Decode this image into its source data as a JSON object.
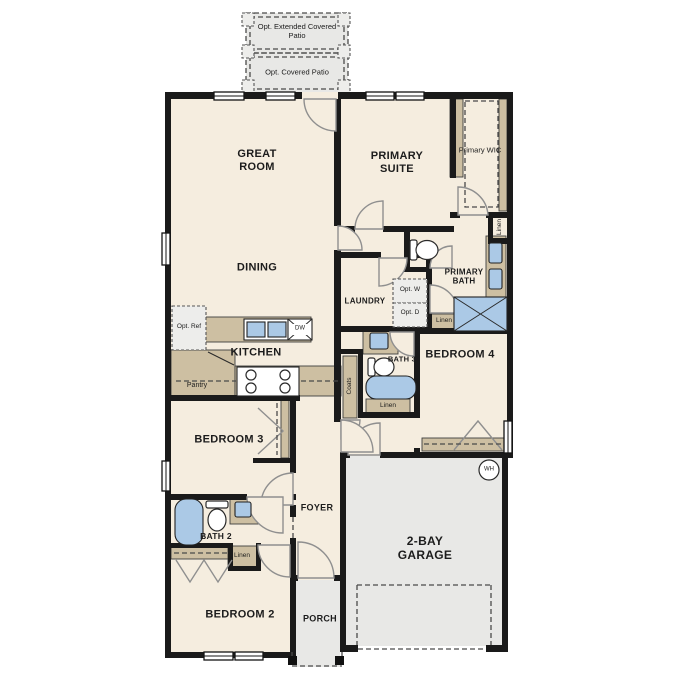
{
  "colors": {
    "floor": "#f5eddf",
    "wall": "#1a1a1a",
    "cabinet": "#cdbfa2",
    "concrete": "#e8e8e6",
    "fixture": "#abc9e6",
    "dash": "#4a4a4a"
  },
  "patio": {
    "extended_label": "Opt. Extended Covered Patio",
    "covered_label": "Opt. Covered Patio"
  },
  "rooms": {
    "great_room": "GREAT ROOM",
    "dining": "DINING",
    "kitchen": "KITCHEN",
    "primary_suite": "PRIMARY SUITE",
    "primary_wic": "Primary WIC",
    "primary_bath": "PRIMARY BATH",
    "laundry": "LAUNDRY",
    "bath_3": "BATH 3",
    "bedroom_4": "BEDROOM 4",
    "bedroom_3": "BEDROOM 3",
    "foyer": "FOYER",
    "bath_2": "BATH 2",
    "bedroom_2": "BEDROOM 2",
    "porch": "PORCH",
    "garage": "2-BAY GARAGE"
  },
  "closets": {
    "pantry": "Pantry",
    "coats": "Coats",
    "linen": "Linen"
  },
  "appliances": {
    "opt_ref": "Opt. Ref",
    "opt_washer": "Opt. W",
    "opt_dryer": "Opt. D",
    "dishwasher": "DW",
    "water_heater": "WH"
  }
}
